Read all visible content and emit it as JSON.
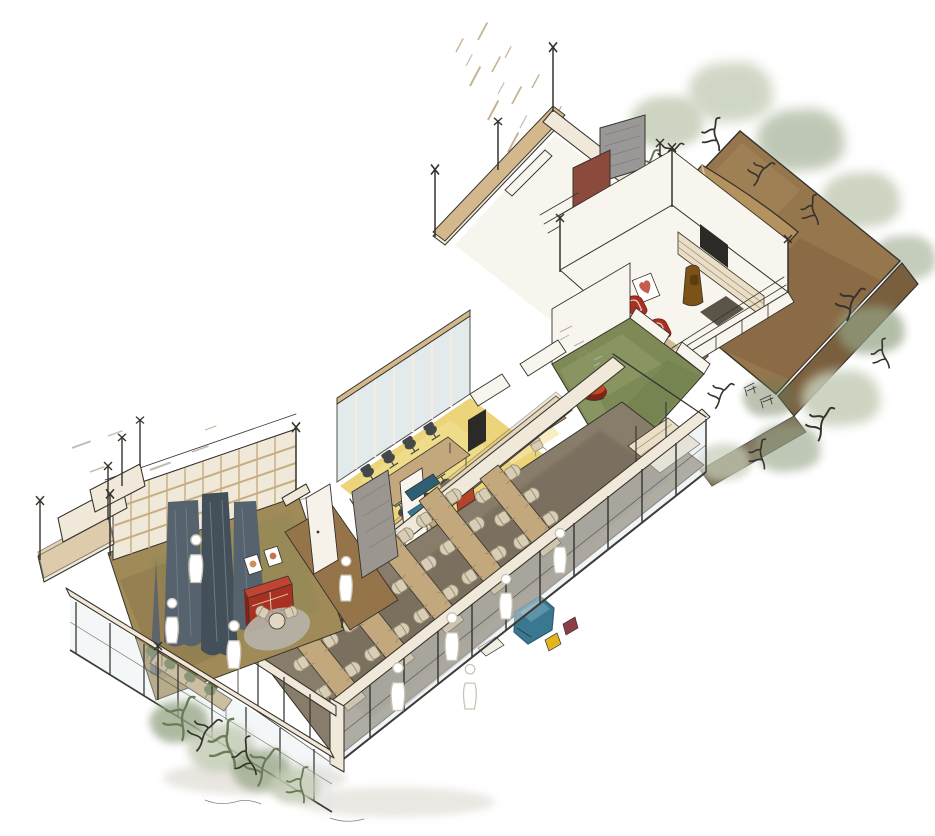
{
  "scene": {
    "label": "Hand-drawn axonometric cutaway sketch of an elongated building interior with roof terrace garden, lounge, meeting room, cafe and dining hall",
    "type": "architectural-axonometric-sketch",
    "style": "ink outlines with watercolor fills on white paper",
    "areas": [
      {
        "name": "roof-terrace-garden",
        "floor_color": "#96764d",
        "features": [
          "canvas-canopy",
          "green-bench",
          "perimeter-planting"
        ]
      },
      {
        "name": "utility-block",
        "features": [
          "gray-shower-panel",
          "maroon-panel",
          "tan-shaft"
        ]
      },
      {
        "name": "lounge-tv-room",
        "features": [
          "two-red-armchairs",
          "heart-picture",
          "wall-shelving",
          "tv-screen",
          "coat-stand"
        ]
      },
      {
        "name": "garden-room",
        "floor_color": "#7d8a55",
        "features": [
          "red-pouf",
          "sketched-wall-frames"
        ]
      },
      {
        "name": "meeting-room",
        "floor_color": "#e9cf6a",
        "features": [
          "long-table",
          "dark-task-chairs",
          "glass-partition",
          "wall-screen"
        ]
      },
      {
        "name": "office-nook",
        "features": [
          "two-desks",
          "white-chairs"
        ]
      },
      {
        "name": "booth-seating",
        "features": [
          "teal-benches",
          "orange-wall-panel"
        ]
      },
      {
        "name": "cafe-alcove",
        "features": [
          "pendant-lamps",
          "round-tables",
          "green-chairs",
          "yellow-glow"
        ]
      },
      {
        "name": "dining-hall",
        "floor_color": "#887d6a",
        "features": [
          "five-long-tables",
          "beige-chairs",
          "teal-sofa",
          "glass-curtain-wall",
          "sideboard"
        ]
      },
      {
        "name": "library-living-room",
        "features": [
          "wood-grid-shelf-wall",
          "slate-curtains",
          "red-sideboard",
          "framed-pictures",
          "round-rug",
          "front-table-green-chairs",
          "planter-palms"
        ]
      }
    ],
    "people_count_hint": 9
  },
  "palette": {
    "paper": "#ffffff",
    "ink": "#36322c",
    "wall_cream": "#f0e9da",
    "wall_white": "#f8f5ee",
    "wall_top": "#d2b88c",
    "wall_tan": "#c2a377",
    "terrace": "#96764d",
    "terrace_dark": "#7a5f3e",
    "canopy": "#b3925f",
    "canopy_light": "#d8c298",
    "foliage_soft": "#c5cdb7",
    "foliage_mid": "#94a384",
    "foliage_dark": "#6b7a57",
    "green_floor": "#7d8a55",
    "yellow_floor": "#e9cf6a",
    "yellow_glow": "#f6e7a6",
    "dining_floor": "#887d6a",
    "dining_dark": "#6f6555",
    "table_tan": "#c2a87c",
    "shelf_cream": "#eadfc6",
    "chair_beige": "#d8cdb5",
    "chair_line": "#978b74",
    "chair_dark": "#45484a",
    "teal": "#3a7891",
    "teal_dark": "#2d5f75",
    "red": "#a93122",
    "red_dark": "#7e2418",
    "maroon": "#8c4a3c",
    "wine": "#8c3d49",
    "curtain": "#56626e",
    "curtain_dark": "#434f59",
    "curtain_hi": "#76838f",
    "rug": "#b6b2a8",
    "green_chair": "#5f6a3c",
    "green_bench": "#2e6b35",
    "yellow_accent": "#e2b51e",
    "glass": "#dfe7e8",
    "mullion": "#3c3b38",
    "gray_panel": "#9a9897",
    "tv": "#2b2a27",
    "wood_grid": "#c8ad80",
    "hatch_tan": "#c6b394",
    "hatch_gray": "#b5b0a6",
    "brown_obj": "#7c5218",
    "shadow": "#b8af9e",
    "people_line": "#c9c3b4",
    "olive_floor": "#a08a58",
    "walkway": "#95744a"
  }
}
